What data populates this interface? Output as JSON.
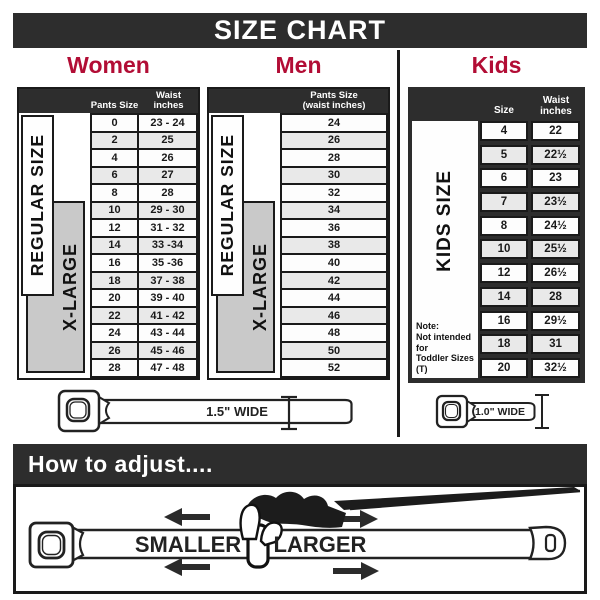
{
  "title": "SIZE CHART",
  "colors": {
    "dark": "#2d2d2d",
    "red": "#b20d35",
    "greybox": "#c9c9c9",
    "rowalt": "#e9e9e9",
    "ink": "#1a1a1a"
  },
  "sections": {
    "women": {
      "label": "Women",
      "side_regular": "REGULAR SIZE",
      "side_xlarge": "X-LARGE",
      "col_size": "Pants Size",
      "col_waist_1": "Waist",
      "col_waist_2": "inches",
      "rows": [
        [
          "0",
          "23 - 24"
        ],
        [
          "2",
          "25"
        ],
        [
          "4",
          "26"
        ],
        [
          "6",
          "27"
        ],
        [
          "8",
          "28"
        ],
        [
          "10",
          "29 - 30"
        ],
        [
          "12",
          "31 - 32"
        ],
        [
          "14",
          "33 -34"
        ],
        [
          "16",
          "35 -36"
        ],
        [
          "18",
          "37 - 38"
        ],
        [
          "20",
          "39 - 40"
        ],
        [
          "22",
          "41 - 42"
        ],
        [
          "24",
          "43 - 44"
        ],
        [
          "26",
          "45 - 46"
        ],
        [
          "28",
          "47 - 48"
        ]
      ]
    },
    "men": {
      "label": "Men",
      "side_regular": "REGULAR SIZE",
      "side_xlarge": "X-LARGE",
      "col_line1": "Pants Size",
      "col_line2": "(waist inches)",
      "rows": [
        "24",
        "26",
        "28",
        "30",
        "32",
        "34",
        "36",
        "38",
        "40",
        "42",
        "44",
        "46",
        "48",
        "50",
        "52"
      ]
    },
    "kids": {
      "label": "Kids",
      "side_label": "KIDS SIZE",
      "col_size": "Size",
      "col_waist_1": "Waist",
      "col_waist_2": "inches",
      "note": [
        "Note:",
        "Not intended for",
        "Toddler Sizes (T)"
      ],
      "rows": [
        [
          "4",
          "22"
        ],
        [
          "5",
          "22½"
        ],
        [
          "6",
          "23"
        ],
        [
          "7",
          "23½"
        ],
        [
          "8",
          "24½"
        ],
        [
          "10",
          "25½"
        ],
        [
          "12",
          "26½"
        ],
        [
          "14",
          "28"
        ],
        [
          "16",
          "29½"
        ],
        [
          "18",
          "31"
        ],
        [
          "20",
          "32½"
        ]
      ]
    }
  },
  "belts": {
    "adult_label": "1.5\" WIDE",
    "kids_label": "1.0\" WIDE"
  },
  "adjust": {
    "heading": "How to adjust....",
    "smaller": "SMALLER",
    "larger": "LARGER"
  },
  "chart_data": [
    {
      "type": "table",
      "title": "Women",
      "columns": [
        "Pants Size",
        "Waist inches"
      ],
      "rows": [
        [
          "0",
          "23 - 24"
        ],
        [
          "2",
          "25"
        ],
        [
          "4",
          "26"
        ],
        [
          "6",
          "27"
        ],
        [
          "8",
          "28"
        ],
        [
          "10",
          "29 - 30"
        ],
        [
          "12",
          "31 - 32"
        ],
        [
          "14",
          "33 -34"
        ],
        [
          "16",
          "35 -36"
        ],
        [
          "18",
          "37 - 38"
        ],
        [
          "20",
          "39 - 40"
        ],
        [
          "22",
          "41 - 42"
        ],
        [
          "24",
          "43 - 44"
        ],
        [
          "26",
          "45 - 46"
        ],
        [
          "28",
          "47 - 48"
        ]
      ],
      "annotations": [
        "REGULAR SIZE: pants 0-18",
        "X-LARGE: pants 10-28",
        "Belt width 1.5 in"
      ]
    },
    {
      "type": "table",
      "title": "Men",
      "columns": [
        "Pants Size (waist inches)"
      ],
      "rows": [
        [
          "24"
        ],
        [
          "26"
        ],
        [
          "28"
        ],
        [
          "30"
        ],
        [
          "32"
        ],
        [
          "34"
        ],
        [
          "36"
        ],
        [
          "38"
        ],
        [
          "40"
        ],
        [
          "42"
        ],
        [
          "44"
        ],
        [
          "46"
        ],
        [
          "48"
        ],
        [
          "50"
        ],
        [
          "52"
        ]
      ],
      "annotations": [
        "REGULAR SIZE: 24-40",
        "X-LARGE: 34-52",
        "Belt width 1.5 in"
      ]
    },
    {
      "type": "table",
      "title": "Kids",
      "columns": [
        "Size",
        "Waist inches"
      ],
      "rows": [
        [
          "4",
          "22"
        ],
        [
          "5",
          "22½"
        ],
        [
          "6",
          "23"
        ],
        [
          "7",
          "23½"
        ],
        [
          "8",
          "24½"
        ],
        [
          "10",
          "25½"
        ],
        [
          "12",
          "26½"
        ],
        [
          "14",
          "28"
        ],
        [
          "16",
          "29½"
        ],
        [
          "18",
          "31"
        ],
        [
          "20",
          "32½"
        ]
      ],
      "annotations": [
        "KIDS SIZE",
        "Not intended for Toddler Sizes (T)",
        "Belt width 1.0 in"
      ]
    }
  ]
}
